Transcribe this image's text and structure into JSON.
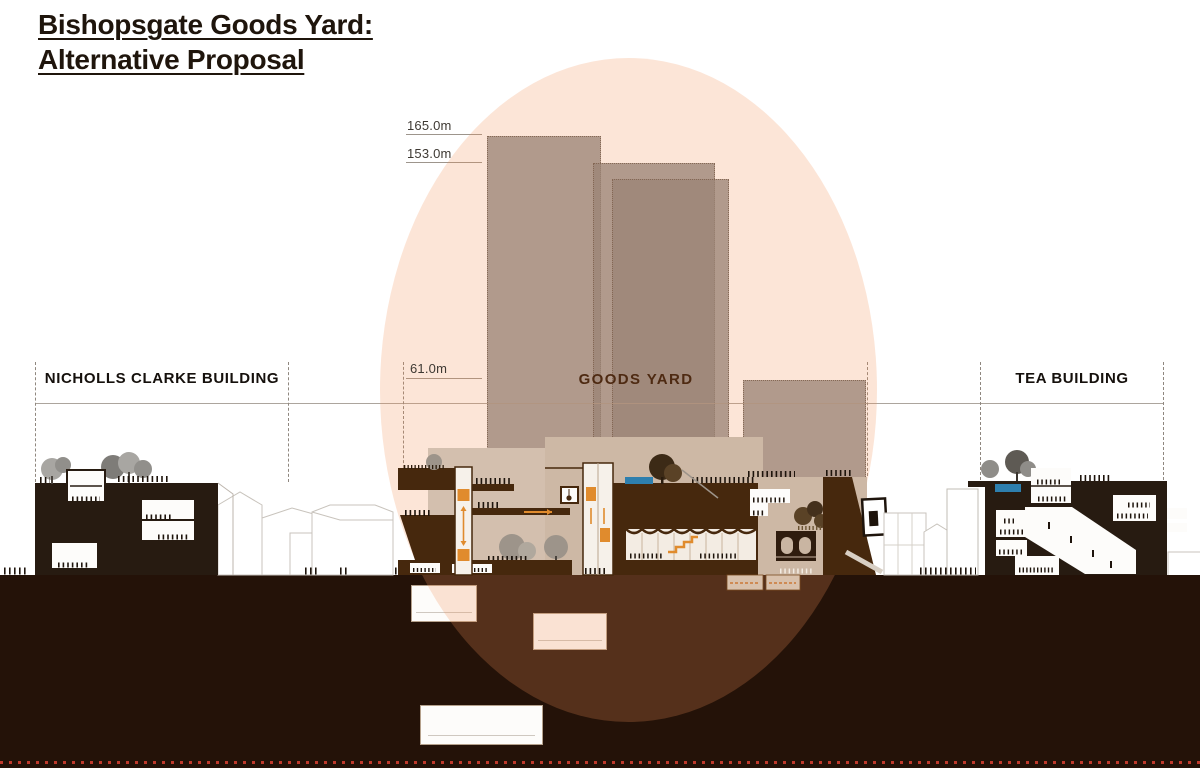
{
  "title": {
    "line1": "Bishopsgate Goods Yard:",
    "line2": "Alternative Proposal"
  },
  "height_markers": [
    {
      "label": "165.0m",
      "value_m": 165.0
    },
    {
      "label": "153.0m",
      "value_m": 153.0
    },
    {
      "label": "61.0m",
      "value_m": 61.0
    }
  ],
  "building_labels": {
    "left": "NICHOLLS CLARKE BUILDING",
    "center": "GOODS YARD",
    "right": "TEA BUILDING"
  },
  "colors": {
    "highlight_overlay": "#F29258",
    "tower_grey": "#828282",
    "ground_dark": "#241208",
    "building_dark": "#271B11",
    "section_brown": "#44270D",
    "backdrop_beige": "#CDB8A5",
    "accent_orange": "#E08B2D",
    "water_blue": "#2E7FAE",
    "boundary_red": "#C0392B"
  }
}
